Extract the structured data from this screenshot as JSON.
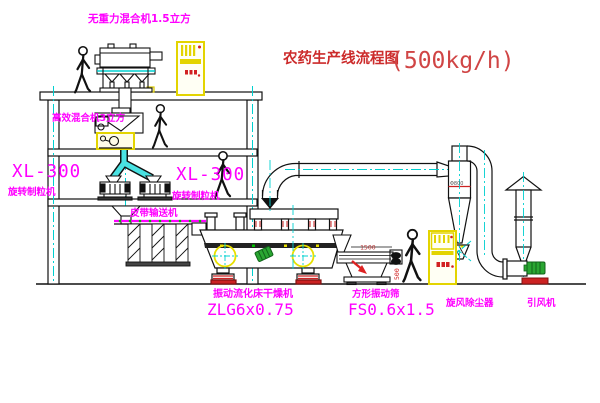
{
  "title": {
    "name": "农药生产线流程图",
    "capacity": "(500kg/h)"
  },
  "equipment": {
    "mixer_top": {
      "label": "无重力混合机1.5立方"
    },
    "mixer_2f": {
      "label": "高效混合机3立方"
    },
    "granulator_left": {
      "model": "XL-300",
      "name": "旋转制粒机"
    },
    "granulator_mid": {
      "model": "XL-300",
      "name": "旋转制粒机"
    },
    "belt_conveyor": {
      "label": "皮带输送机"
    },
    "dryer": {
      "name": "振动流化床干燥机",
      "model": "ZLG6x0.75"
    },
    "sieve": {
      "name": "方形振动筛",
      "model": "FS0.6x1.5"
    },
    "cyclone": {
      "label": "旋风除尘器",
      "dim": "Φ800"
    },
    "fan": {
      "label": "引风机"
    }
  },
  "dimensions": {
    "sieve_length": "1500",
    "sieve_height": "500"
  },
  "colors": {
    "label_magenta": "#ff00ff",
    "title_red": "#cc2b2b",
    "centerline_cyan": "#00d0d0",
    "cabinet_yellow": "#e3d400",
    "base_red": "#cc2222",
    "motor_green": "#2aa632"
  }
}
